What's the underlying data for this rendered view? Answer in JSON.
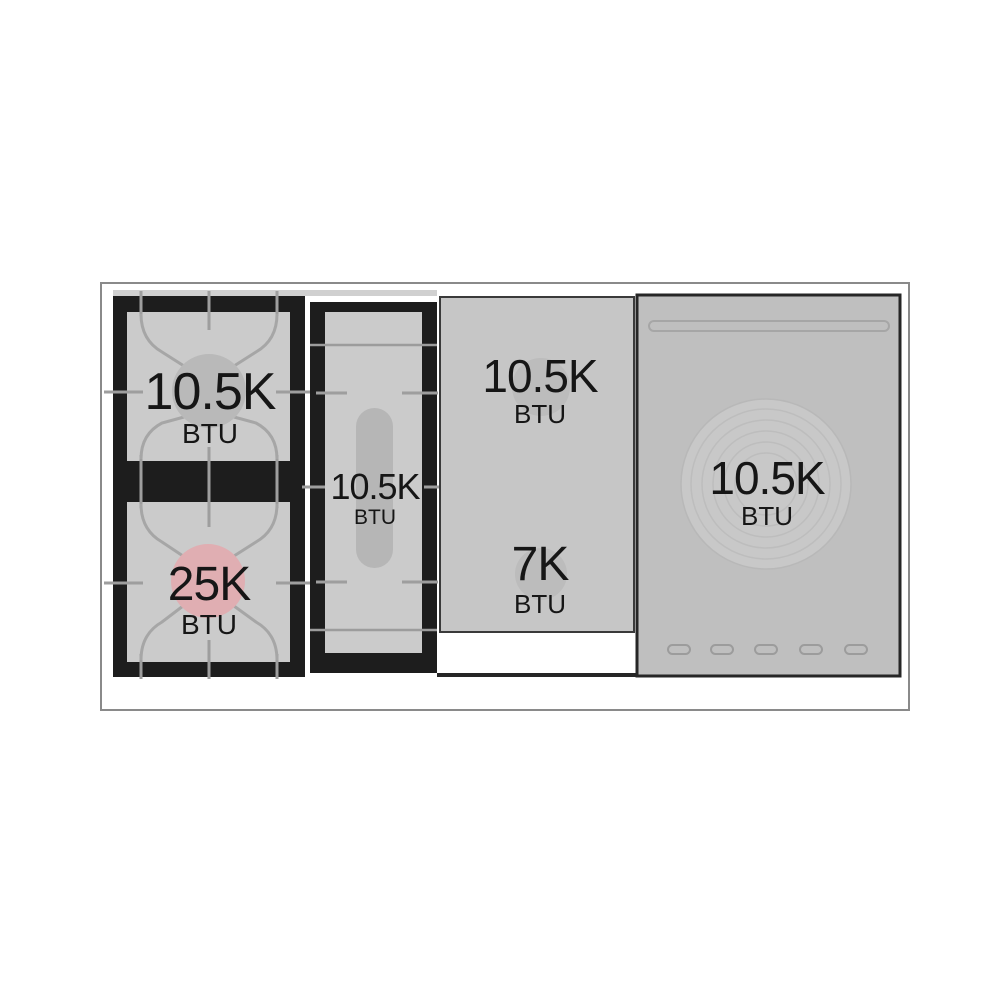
{
  "burners": {
    "left_rear": {
      "value": "10.5K",
      "unit": "BTU"
    },
    "left_front": {
      "value": "25K",
      "unit": "BTU"
    },
    "center_oval": {
      "value": "10.5K",
      "unit": "BTU"
    },
    "griddle_rear": {
      "value": "10.5K",
      "unit": "BTU"
    },
    "griddle_front": {
      "value": "7K",
      "unit": "BTU"
    },
    "french_top": {
      "value": "10.5K",
      "unit": "BTU"
    }
  },
  "colors": {
    "background": "#ffffff",
    "grate_black": "#1d1d1d",
    "grate_inner_gray": "#cbcbcb",
    "griddle_gray": "#c6c6c6",
    "french_top_gray": "#bfbfbf",
    "burner_circle_gray": "#b9b9b9",
    "high_btu_pink": "#e0aeb2",
    "tick_line_gray": "#9e9e9e",
    "outline_gray": "#8a8a8a",
    "text": "#161616"
  }
}
